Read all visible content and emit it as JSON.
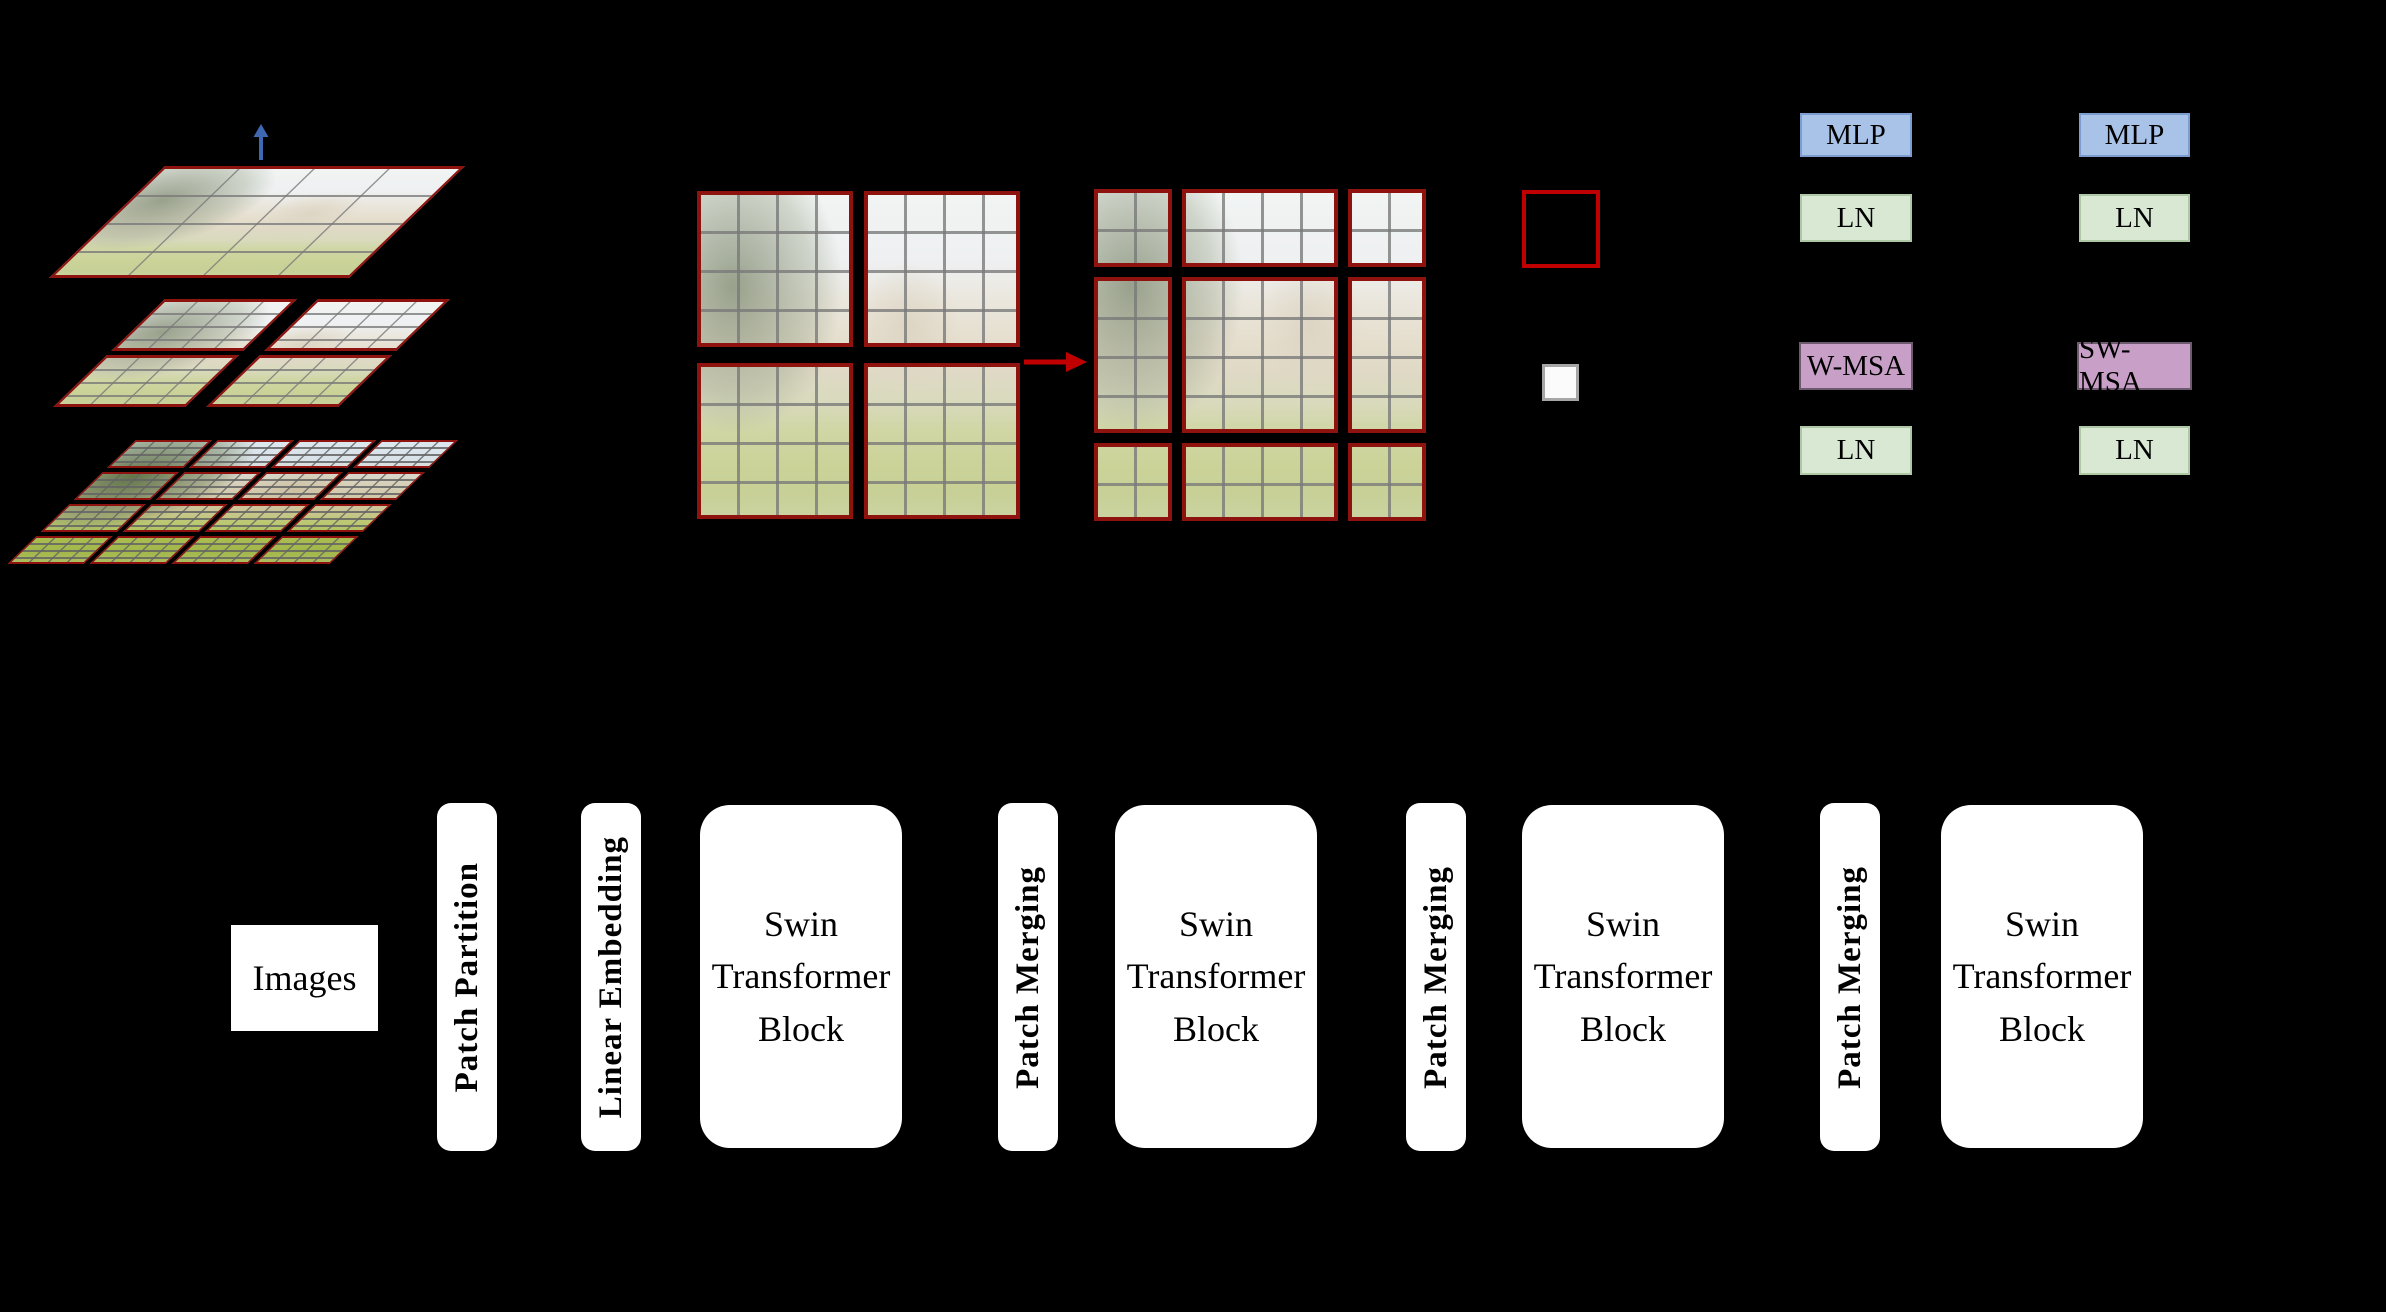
{
  "colors": {
    "background": "#000000",
    "window_border_dark_red": "#8e120e",
    "legend_window_red": "#c00000",
    "shift_arrow_red": "#c00000",
    "hierarchy_arrow_blue": "#3e68b1",
    "mlp_fill": "#a9c2e8",
    "ln_fill": "#d9e8d3",
    "msa_fill": "#c8a0c7",
    "pipeline_box_fill": "#ffffff",
    "legend_patch_fill": "#fbfbfb",
    "legend_patch_border": "#a6a6a6"
  },
  "hierarchy": {
    "arrow_direction": "up",
    "levels": [
      {
        "name": "top-feature-map",
        "partition": {
          "windows_x": 1,
          "windows_y": 1,
          "patches_x": 4,
          "patches_y": 4
        }
      },
      {
        "name": "middle-feature-map",
        "partition": {
          "windows_x": 2,
          "windows_y": 2,
          "patches_x": 4,
          "patches_y": 4
        }
      },
      {
        "name": "bottom-feature-map",
        "partition": {
          "windows_x": 4,
          "windows_y": 4,
          "patches_x": 4,
          "patches_y": 4
        }
      }
    ]
  },
  "shift_illustration": {
    "arrow_direction": "right",
    "left_grid": {
      "windows_x": 2,
      "windows_y": 2,
      "patches_x": 4,
      "patches_y": 4
    },
    "right_grid": {
      "col_patches": [
        2,
        4,
        2
      ],
      "row_patches": [
        2,
        4,
        2
      ]
    }
  },
  "legend": {
    "window_swatch": "red-outlined window",
    "patch_swatch": "gray-bordered patch"
  },
  "transformer_block_pair": {
    "left": [
      "MLP",
      "LN",
      "W-MSA",
      "LN"
    ],
    "right": [
      "MLP",
      "LN",
      "SW-MSA",
      "LN"
    ]
  },
  "pipeline": [
    {
      "kind": "box",
      "label": "Images"
    },
    {
      "kind": "bar",
      "label": "Patch Partition"
    },
    {
      "kind": "bar",
      "label": "Linear Embedding"
    },
    {
      "kind": "block",
      "label": "Swin Transformer Block"
    },
    {
      "kind": "bar",
      "label": "Patch Merging"
    },
    {
      "kind": "block",
      "label": "Swin Transformer Block"
    },
    {
      "kind": "bar",
      "label": "Patch Merging"
    },
    {
      "kind": "block",
      "label": "Swin Transformer Block"
    },
    {
      "kind": "bar",
      "label": "Patch Merging"
    },
    {
      "kind": "block",
      "label": "Swin Transformer Block"
    }
  ]
}
